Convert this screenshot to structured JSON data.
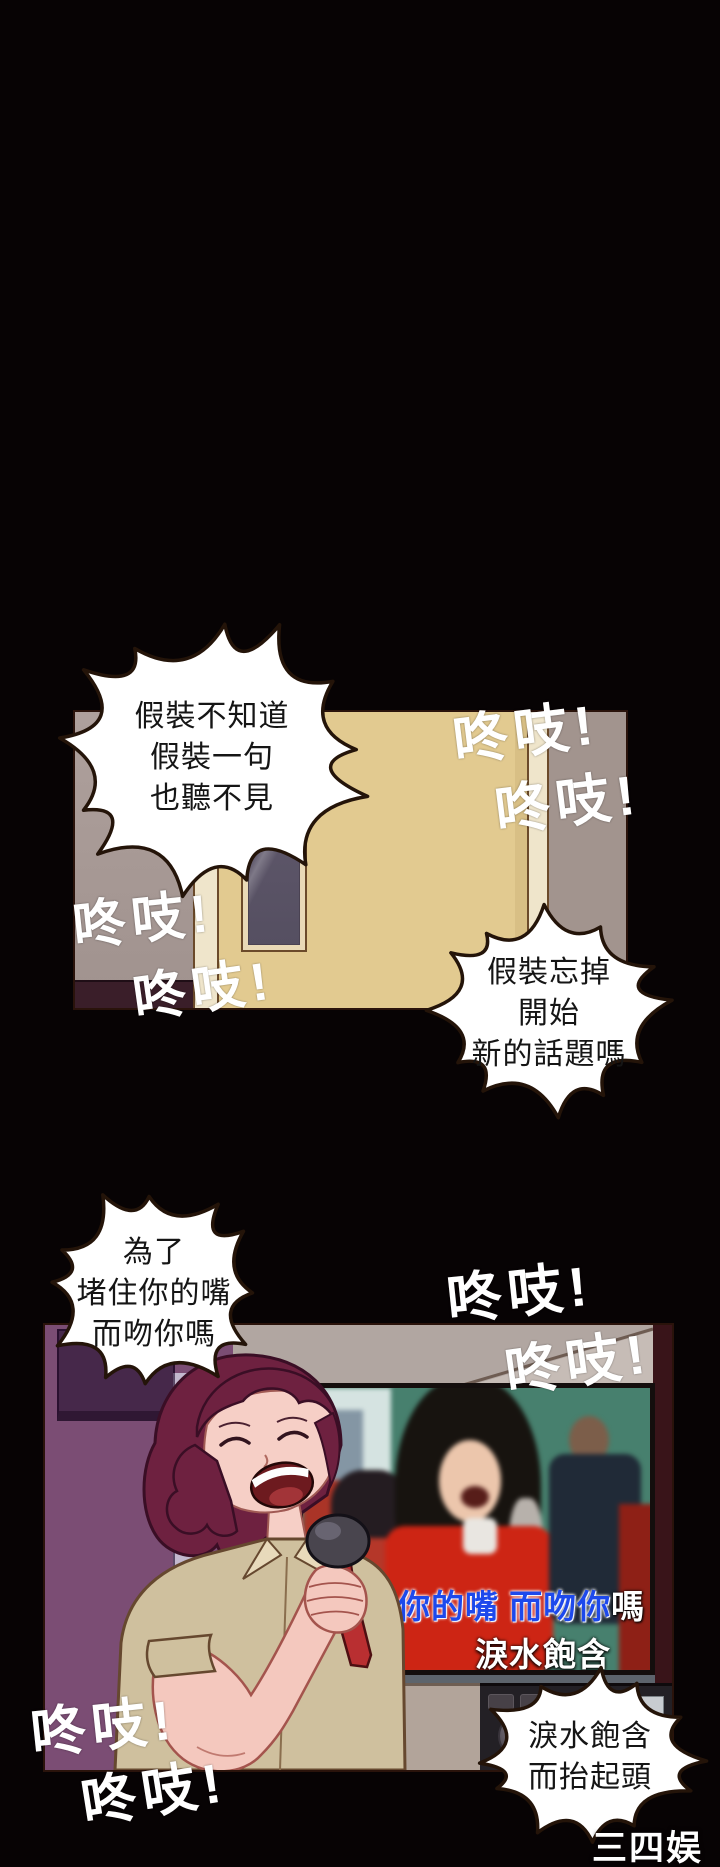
{
  "page": {
    "width": 720,
    "height": 1867,
    "background": "#070304",
    "description": "vertical webtoon comic strip, two karaoke-scene panels on black"
  },
  "speech_bubbles": {
    "pretend_not_know": {
      "line1": "假裝不知道",
      "line2": "假裝一句",
      "line3": "也聽不見"
    },
    "pretend_forget": {
      "line1": "假裝忘掉",
      "line2": "開始",
      "line3": "新的話題嗎"
    },
    "shut_mouth": {
      "line1": "為了",
      "line2": "堵住你的嘴",
      "line3": "而吻你嗎"
    },
    "tears_rise": {
      "line1": "淚水飽含",
      "line2": "而抬起頭"
    }
  },
  "sfx": {
    "knock": "咚吱!"
  },
  "tv": {
    "subtitle_sung": "住你的嘴 而吻你",
    "subtitle_tail": "嗎",
    "subtitle_line2": "淚水飽含"
  },
  "watermark": {
    "text": "三四娱乐"
  },
  "colors": {
    "background": "#070304",
    "bubble_fill": "#ffffff",
    "bubble_outline": "#241409",
    "sfx_text": "#ffffff",
    "subtitle_blue": "#1d49ec",
    "subtitle_white": "#ffffff",
    "door_tan": "#e2ca90",
    "door_frame_cream": "#efe5cb",
    "hall_wall_gray": "#a79a96",
    "floor_maroon": "#3a1e29",
    "karaoke_wall_purple": "#7b4d74",
    "cabinet_purple": "#46284a",
    "tv_teal": "#47806e",
    "hair_burgundy": "#6e2140",
    "skin_pink": "#f4c8be",
    "shirt_tan": "#cfc09e",
    "mic_red": "#b92f31",
    "watermark_white": "#ffffff"
  }
}
